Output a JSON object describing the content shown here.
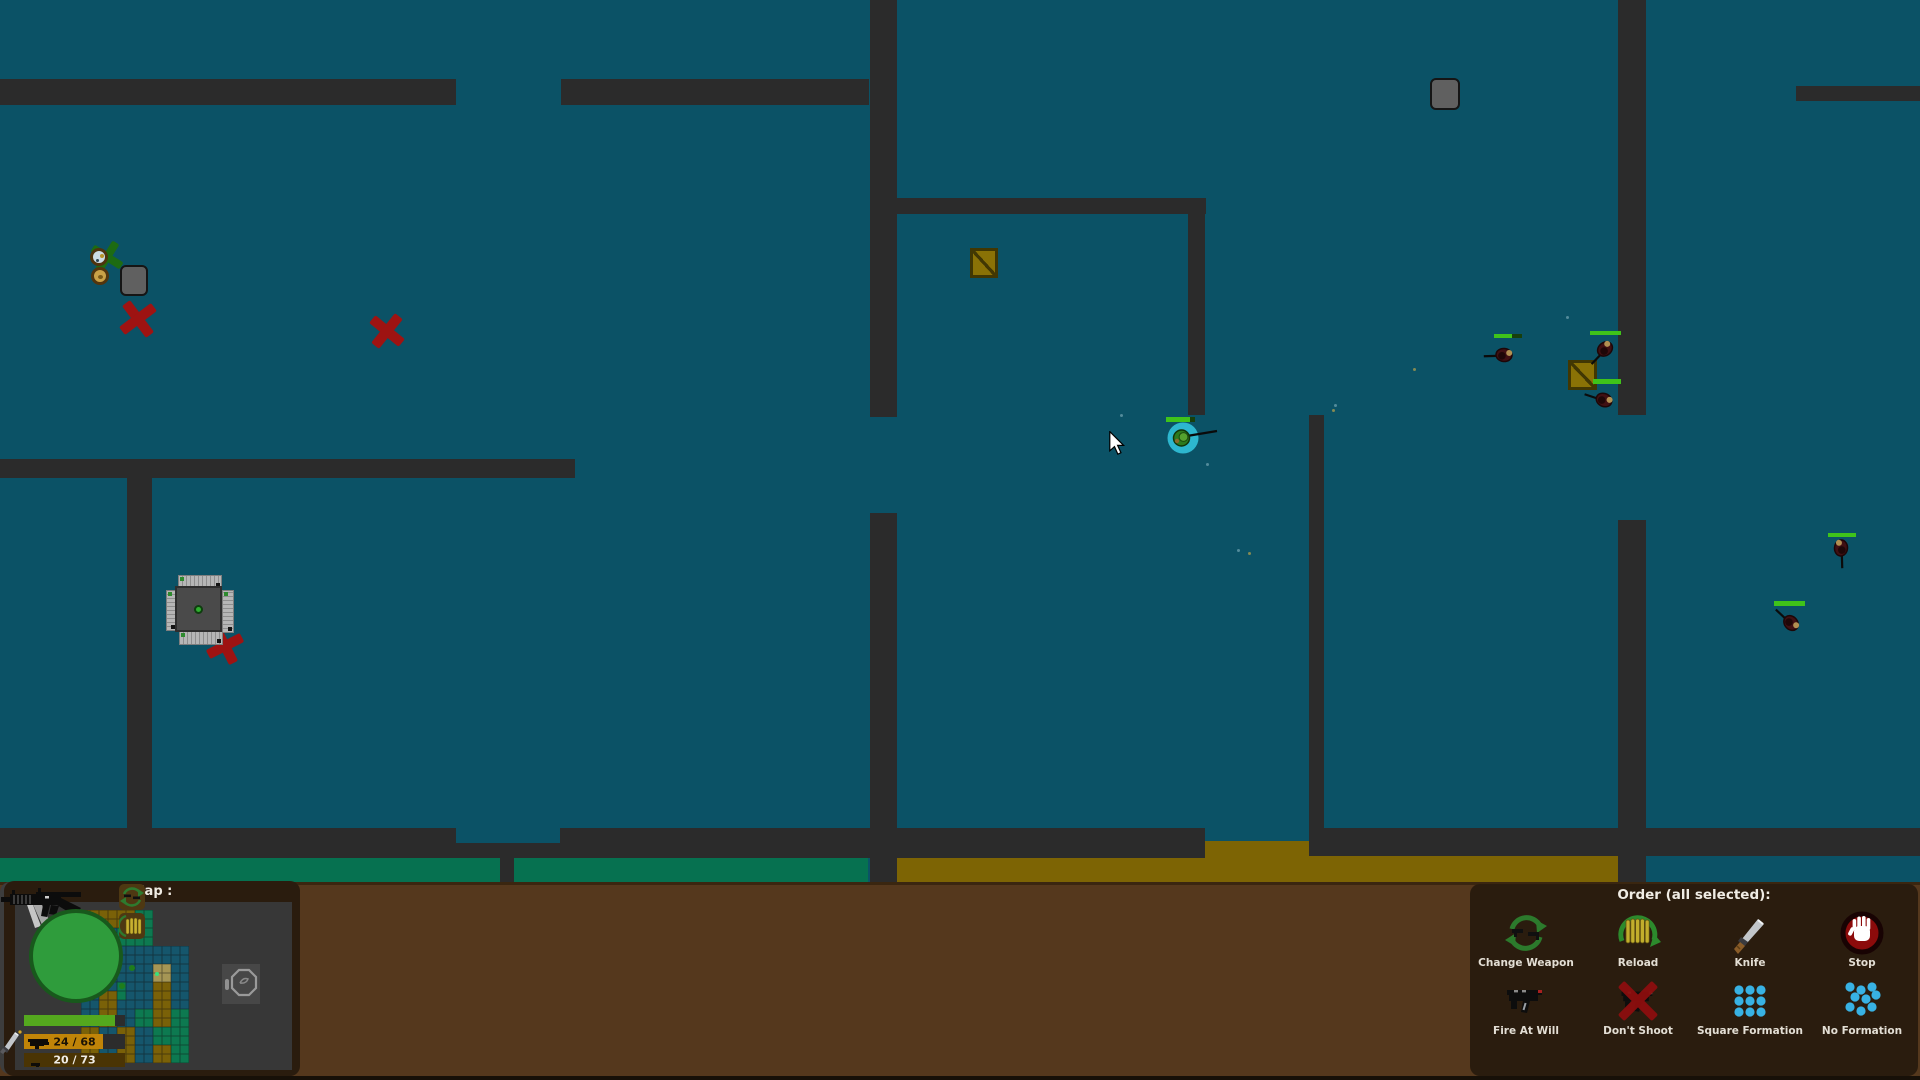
{
  "colors": {
    "floor": "#0b5266",
    "wall": "#2b2b2b",
    "strip_green": "#067150",
    "strip_gold": "#7d6404",
    "ui_bar": "#55381d",
    "panel_dark": "#2a1c0e",
    "hud_panel": "#3d3d3d",
    "portrait_green": "#2f9c3c",
    "health_green": "#54a81e",
    "ammo_gold": "#c08408",
    "ammo_dark": "#4a3404",
    "selection_cyan": "#2db7cf",
    "enemy_body": "#401013",
    "red_mark": "#9e1312",
    "crate_gold": "#8a7206",
    "formation_dot": "#38b2e4",
    "order_icon_green": "#2c7a2c",
    "unit_health": "#3fc31a"
  },
  "minimap": {
    "title": "Map :",
    "tile_colors": {
      "1": "#7a6108",
      "2": "#15566c",
      "3": "#0d7950",
      "4": "#a59655"
    },
    "origin": {
      "x": 81,
      "y": 911
    },
    "tile_size": 9,
    "tiles": [
      [
        1,
        1,
        1,
        1,
        1,
        1,
        3,
        3,
        0,
        0,
        0,
        0
      ],
      [
        1,
        1,
        1,
        1,
        1,
        1,
        3,
        3,
        0,
        0,
        0,
        0
      ],
      [
        2,
        2,
        2,
        2,
        3,
        3,
        3,
        3,
        0,
        0,
        0,
        0
      ],
      [
        2,
        2,
        2,
        2,
        3,
        3,
        3,
        3,
        0,
        0,
        0,
        0
      ],
      [
        1,
        1,
        2,
        2,
        2,
        2,
        2,
        2,
        2,
        2,
        2,
        2
      ],
      [
        1,
        1,
        2,
        2,
        2,
        2,
        2,
        2,
        2,
        2,
        2,
        2
      ],
      [
        1,
        1,
        2,
        2,
        2,
        2,
        2,
        2,
        4,
        4,
        2,
        2
      ],
      [
        1,
        1,
        2,
        2,
        2,
        2,
        2,
        2,
        4,
        4,
        2,
        2
      ],
      [
        2,
        2,
        2,
        2,
        3,
        2,
        2,
        2,
        1,
        1,
        2,
        2
      ],
      [
        2,
        2,
        1,
        1,
        3,
        2,
        2,
        2,
        1,
        1,
        2,
        2
      ],
      [
        2,
        2,
        1,
        1,
        2,
        2,
        2,
        2,
        1,
        1,
        2,
        2
      ],
      [
        2,
        2,
        1,
        1,
        2,
        2,
        3,
        3,
        1,
        1,
        3,
        3
      ],
      [
        2,
        2,
        1,
        1,
        2,
        2,
        3,
        3,
        1,
        1,
        3,
        3
      ],
      [
        1,
        1,
        2,
        2,
        1,
        1,
        2,
        2,
        3,
        3,
        3,
        3
      ],
      [
        1,
        1,
        2,
        2,
        1,
        1,
        2,
        2,
        3,
        3,
        3,
        3
      ],
      [
        1,
        1,
        2,
        2,
        1,
        1,
        2,
        2,
        1,
        1,
        3,
        3
      ],
      [
        1,
        1,
        2,
        2,
        1,
        1,
        2,
        2,
        1,
        1,
        3,
        3
      ]
    ],
    "dots": [
      {
        "x": 132,
        "y": 969,
        "s": 6,
        "c": "#1f7d1b"
      },
      {
        "x": 122,
        "y": 987,
        "s": 6,
        "c": "#1f7d1b"
      },
      {
        "x": 157,
        "y": 975,
        "s": 4,
        "c": "#38e07c"
      },
      {
        "x": 103,
        "y": 1039,
        "s": 8,
        "c": "#2bdb6e"
      }
    ]
  },
  "hud": {
    "health_pct": 90,
    "primary_ammo": {
      "text": "24 / 68",
      "fill_pct": 78
    },
    "secondary_ammo": {
      "text": "20 / 73",
      "fill_pct": 100
    }
  },
  "order": {
    "title": "Order (all selected):",
    "buttons": [
      {
        "id": "change-weapon",
        "label": "Change Weapon"
      },
      {
        "id": "reload",
        "label": "Reload"
      },
      {
        "id": "knife",
        "label": "Knife"
      },
      {
        "id": "stop",
        "label": "Stop"
      },
      {
        "id": "fire-at-will",
        "label": "Fire At Will"
      },
      {
        "id": "dont-shoot",
        "label": "Don't Shoot"
      },
      {
        "id": "square-formation",
        "label": "Square Formation"
      },
      {
        "id": "no-formation",
        "label": "No Formation"
      }
    ]
  },
  "world": {
    "walls": [
      [
        0,
        79,
        456,
        26
      ],
      [
        561,
        79,
        308,
        26
      ],
      [
        870,
        0,
        27,
        417
      ],
      [
        896,
        198,
        310,
        16
      ],
      [
        1188,
        214,
        17,
        201
      ],
      [
        1796,
        86,
        124,
        15
      ],
      [
        1618,
        0,
        28,
        415
      ],
      [
        1618,
        520,
        28,
        362
      ],
      [
        870,
        513,
        27,
        369
      ],
      [
        0,
        459,
        575,
        19
      ],
      [
        127,
        478,
        25,
        350
      ],
      [
        0,
        828,
        456,
        30
      ],
      [
        456,
        843,
        104,
        15
      ],
      [
        560,
        828,
        645,
        30
      ],
      [
        1309,
        828,
        611,
        28
      ],
      [
        1309,
        415,
        15,
        413
      ],
      [
        500,
        858,
        14,
        24
      ]
    ],
    "strips": [
      {
        "x": 0,
        "y": 858,
        "w": 500,
        "h": 24,
        "c": "green"
      },
      {
        "x": 514,
        "y": 858,
        "w": 354,
        "h": 24,
        "c": "green"
      },
      {
        "x": 897,
        "y": 856,
        "w": 721,
        "h": 26,
        "c": "gold"
      },
      {
        "x": 1205,
        "y": 841,
        "w": 104,
        "h": 17,
        "c": "gold"
      }
    ],
    "crates": [
      [
        970,
        248,
        28,
        30
      ],
      [
        1568,
        360,
        29,
        30
      ]
    ],
    "gray_boxes": [
      [
        120,
        265,
        28,
        31
      ],
      [
        1430,
        78,
        30,
        32
      ]
    ],
    "red_marks": [
      {
        "x": 138,
        "y": 319,
        "s": 40,
        "rot": 8
      },
      {
        "x": 387,
        "y": 331,
        "s": 38,
        "rot": -6
      },
      {
        "x": 225,
        "y": 646,
        "s": 38,
        "rot": 18
      }
    ],
    "green_mark": {
      "x": 107,
      "y": 257,
      "s": 34,
      "rot": -8
    },
    "items": [
      {
        "x": 99,
        "y": 257,
        "d": 18,
        "type": "light"
      },
      {
        "x": 100,
        "y": 276,
        "d": 18,
        "type": "tan"
      }
    ],
    "bunker": {
      "x": 166,
      "y": 573
    },
    "soldiers": [
      {
        "x": 1504,
        "y": 355,
        "rot": 185
      },
      {
        "x": 1605,
        "y": 349,
        "rot": 140
      },
      {
        "x": 1604,
        "y": 400,
        "rot": 205
      },
      {
        "x": 1841,
        "y": 548,
        "rot": 95
      },
      {
        "x": 1791,
        "y": 623,
        "rot": 230
      }
    ],
    "health_bars": [
      {
        "x": 1494,
        "y": 334,
        "w": 28,
        "h": 4,
        "pct": 65
      },
      {
        "x": 1590,
        "y": 331,
        "w": 31,
        "h": 4,
        "pct": 100
      },
      {
        "x": 1593,
        "y": 379,
        "w": 28,
        "h": 5,
        "pct": 100
      },
      {
        "x": 1828,
        "y": 533,
        "w": 28,
        "h": 4,
        "pct": 100
      },
      {
        "x": 1774,
        "y": 601,
        "w": 31,
        "h": 5,
        "pct": 100
      },
      {
        "x": 1166,
        "y": 417,
        "w": 29,
        "h": 5,
        "pct": 83
      }
    ],
    "player": {
      "x": 1183,
      "y": 438
    },
    "specks": [
      {
        "x": 1120,
        "y": 414,
        "c": "light"
      },
      {
        "x": 1206,
        "y": 463,
        "c": "light"
      },
      {
        "x": 1237,
        "y": 549,
        "c": "light"
      },
      {
        "x": 1334,
        "y": 404,
        "c": "light"
      },
      {
        "x": 1566,
        "y": 316,
        "c": "light"
      },
      {
        "x": 1413,
        "y": 368,
        "c": "gold"
      },
      {
        "x": 1332,
        "y": 409,
        "c": "gold"
      },
      {
        "x": 1248,
        "y": 552,
        "c": "gold"
      }
    ]
  },
  "cursor": {
    "x": 1107,
    "y": 431
  }
}
